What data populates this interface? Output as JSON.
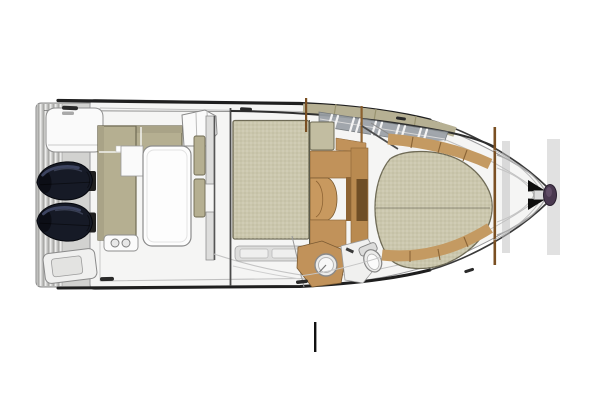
{
  "colors": {
    "background": "#ffffff",
    "hull": "#f5f5f4",
    "hull_outline": "#98989a",
    "inner_line": "#c0c0c0",
    "rub_rail": "#1f1f1f",
    "rub_rail_soft": "#3a3a3a",
    "platform": "#d2d2d0",
    "platform_tread": "#c6c6c4",
    "module_white": "#fafafa",
    "module_stroke": "#8f8f8f",
    "engine_body": "#161a26",
    "engine_nose": "#0c0e16",
    "engine_highlight": "#3d4460",
    "engine_mount": "#202020",
    "cushion": "#b5af91",
    "cushion_backrest": "#a9a387",
    "cushion_outline": "#706b53",
    "berth": "#cbc7ad",
    "berth_outline": "#6e6a55",
    "berth_seam": "#8d8975",
    "table": "#fdfdfd",
    "wood": "#c1925a",
    "wood_mid": "#b98a50",
    "wood_dark": "#8e6434",
    "wood_deep": "#6f4e26",
    "wood_trim": "#c49a62",
    "side_pad": "#b6b093",
    "glass": "#9aa0a6",
    "header_dark": "#2e2e2e",
    "mullion": "#f4f4f4",
    "bulkhead_brown": "#7a4f22",
    "post_brown": "#8a5c28",
    "wall": "#dddddc",
    "window_band": "#dcdcdb",
    "fixture": "#f0f0ef",
    "anchor_body": "#4a3950",
    "anchor_sheen": "#6b5570",
    "chock_black": "#0e0e0e",
    "mark": "#2a2a2a",
    "bow_strip": "#bdbdbd",
    "tick_black": "#111111"
  }
}
